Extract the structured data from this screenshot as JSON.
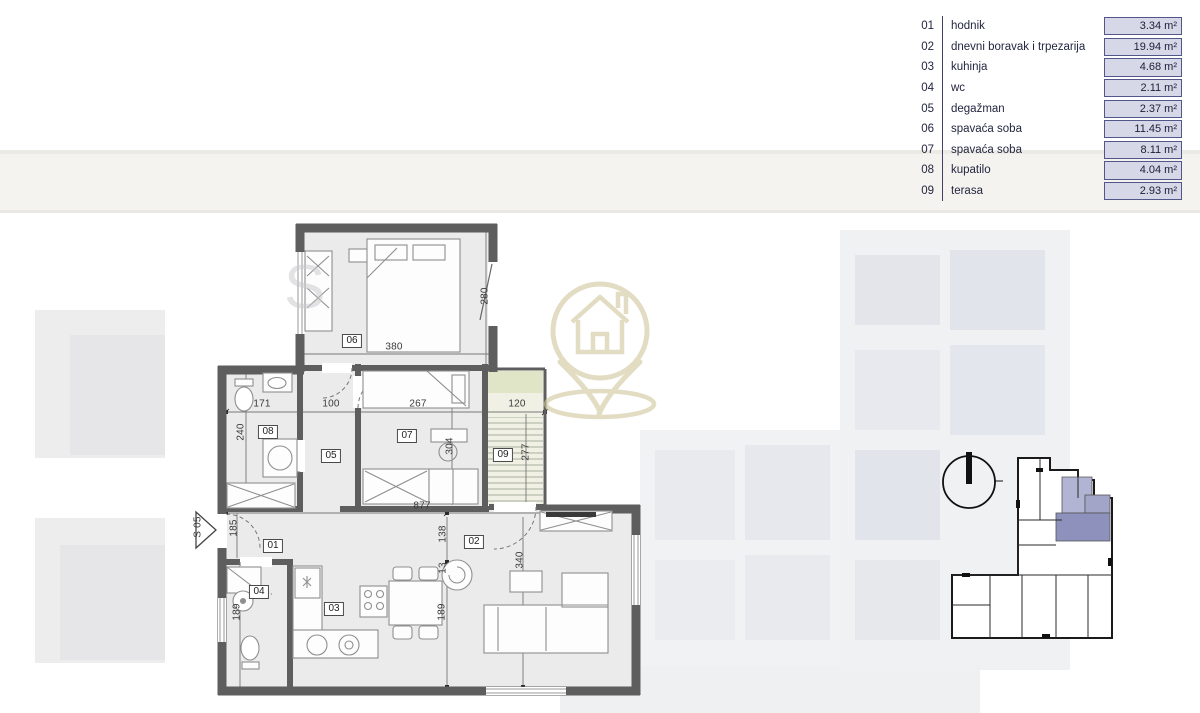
{
  "legend": {
    "rows": [
      {
        "num": "01",
        "name": "hodnik",
        "area": "3.34 m²"
      },
      {
        "num": "02",
        "name": "dnevni boravak i trpezarija",
        "area": "19.94 m²"
      },
      {
        "num": "03",
        "name": "kuhinja",
        "area": "4.68 m²"
      },
      {
        "num": "04",
        "name": "wc",
        "area": "2.11 m²"
      },
      {
        "num": "05",
        "name": "degažman",
        "area": "2.37 m²"
      },
      {
        "num": "06",
        "name": "spavaća soba",
        "area": "11.45 m²"
      },
      {
        "num": "07",
        "name": "spavaća soba",
        "area": "8.11 m²"
      },
      {
        "num": "08",
        "name": "kupatilo",
        "area": "4.04 m²"
      },
      {
        "num": "09",
        "name": "terasa",
        "area": "2.93 m²"
      }
    ]
  },
  "watermark": {
    "letter": "S"
  },
  "plan": {
    "annotations": [
      {
        "kind": "room",
        "text": "01",
        "x": 273,
        "y": 546
      },
      {
        "kind": "room",
        "text": "02",
        "x": 474,
        "y": 542
      },
      {
        "kind": "room",
        "text": "03",
        "x": 334,
        "y": 609
      },
      {
        "kind": "room",
        "text": "04",
        "x": 259,
        "y": 592
      },
      {
        "kind": "room",
        "text": "05",
        "x": 331,
        "y": 456
      },
      {
        "kind": "room",
        "text": "06",
        "x": 352,
        "y": 341
      },
      {
        "kind": "room",
        "text": "07",
        "x": 407,
        "y": 436
      },
      {
        "kind": "room",
        "text": "08",
        "x": 268,
        "y": 432
      },
      {
        "kind": "room",
        "text": "09",
        "x": 503,
        "y": 455
      },
      {
        "kind": "dim",
        "text": "380",
        "x": 394,
        "y": 347,
        "rot": false
      },
      {
        "kind": "dim",
        "text": "280",
        "x": 485,
        "y": 296,
        "rot": true
      },
      {
        "kind": "dim",
        "text": "171",
        "x": 262,
        "y": 404,
        "rot": false
      },
      {
        "kind": "dim",
        "text": "100",
        "x": 331,
        "y": 404,
        "rot": false
      },
      {
        "kind": "dim",
        "text": "267",
        "x": 418,
        "y": 404,
        "rot": false
      },
      {
        "kind": "dim",
        "text": "120",
        "x": 517,
        "y": 404,
        "rot": false
      },
      {
        "kind": "dim",
        "text": "240",
        "x": 241,
        "y": 432,
        "rot": true
      },
      {
        "kind": "dim",
        "text": "304",
        "x": 450,
        "y": 446,
        "rot": true
      },
      {
        "kind": "dim",
        "text": "277",
        "x": 526,
        "y": 452,
        "rot": true
      },
      {
        "kind": "dim",
        "text": "877",
        "x": 422,
        "y": 506,
        "rot": false
      },
      {
        "kind": "dim",
        "text": "185",
        "x": 234,
        "y": 528,
        "rot": true
      },
      {
        "kind": "dim",
        "text": "138",
        "x": 443,
        "y": 534,
        "rot": true
      },
      {
        "kind": "dim",
        "text": "13",
        "x": 443,
        "y": 568,
        "rot": true
      },
      {
        "kind": "dim",
        "text": "340",
        "x": 520,
        "y": 560,
        "rot": true
      },
      {
        "kind": "dim",
        "text": "189",
        "x": 237,
        "y": 612,
        "rot": true
      },
      {
        "kind": "dim",
        "text": "189",
        "x": 442,
        "y": 612,
        "rot": true
      },
      {
        "kind": "dim",
        "text": "S 05",
        "x": 198,
        "y": 527,
        "rot": true
      }
    ]
  },
  "logo": {
    "icon": "house-location-pin-logo",
    "color": "#d0c59c"
  },
  "site_plan": {
    "highlight_light": "#b2b4d3",
    "highlight_mid": "#a2a5c8",
    "highlight_dark": "#8d91bc"
  },
  "colors": {
    "wall": "#5e5e5e",
    "room_fill": "#ebebeb",
    "legend_box_fill": "#d7d8e7",
    "legend_box_border": "#53568a"
  }
}
